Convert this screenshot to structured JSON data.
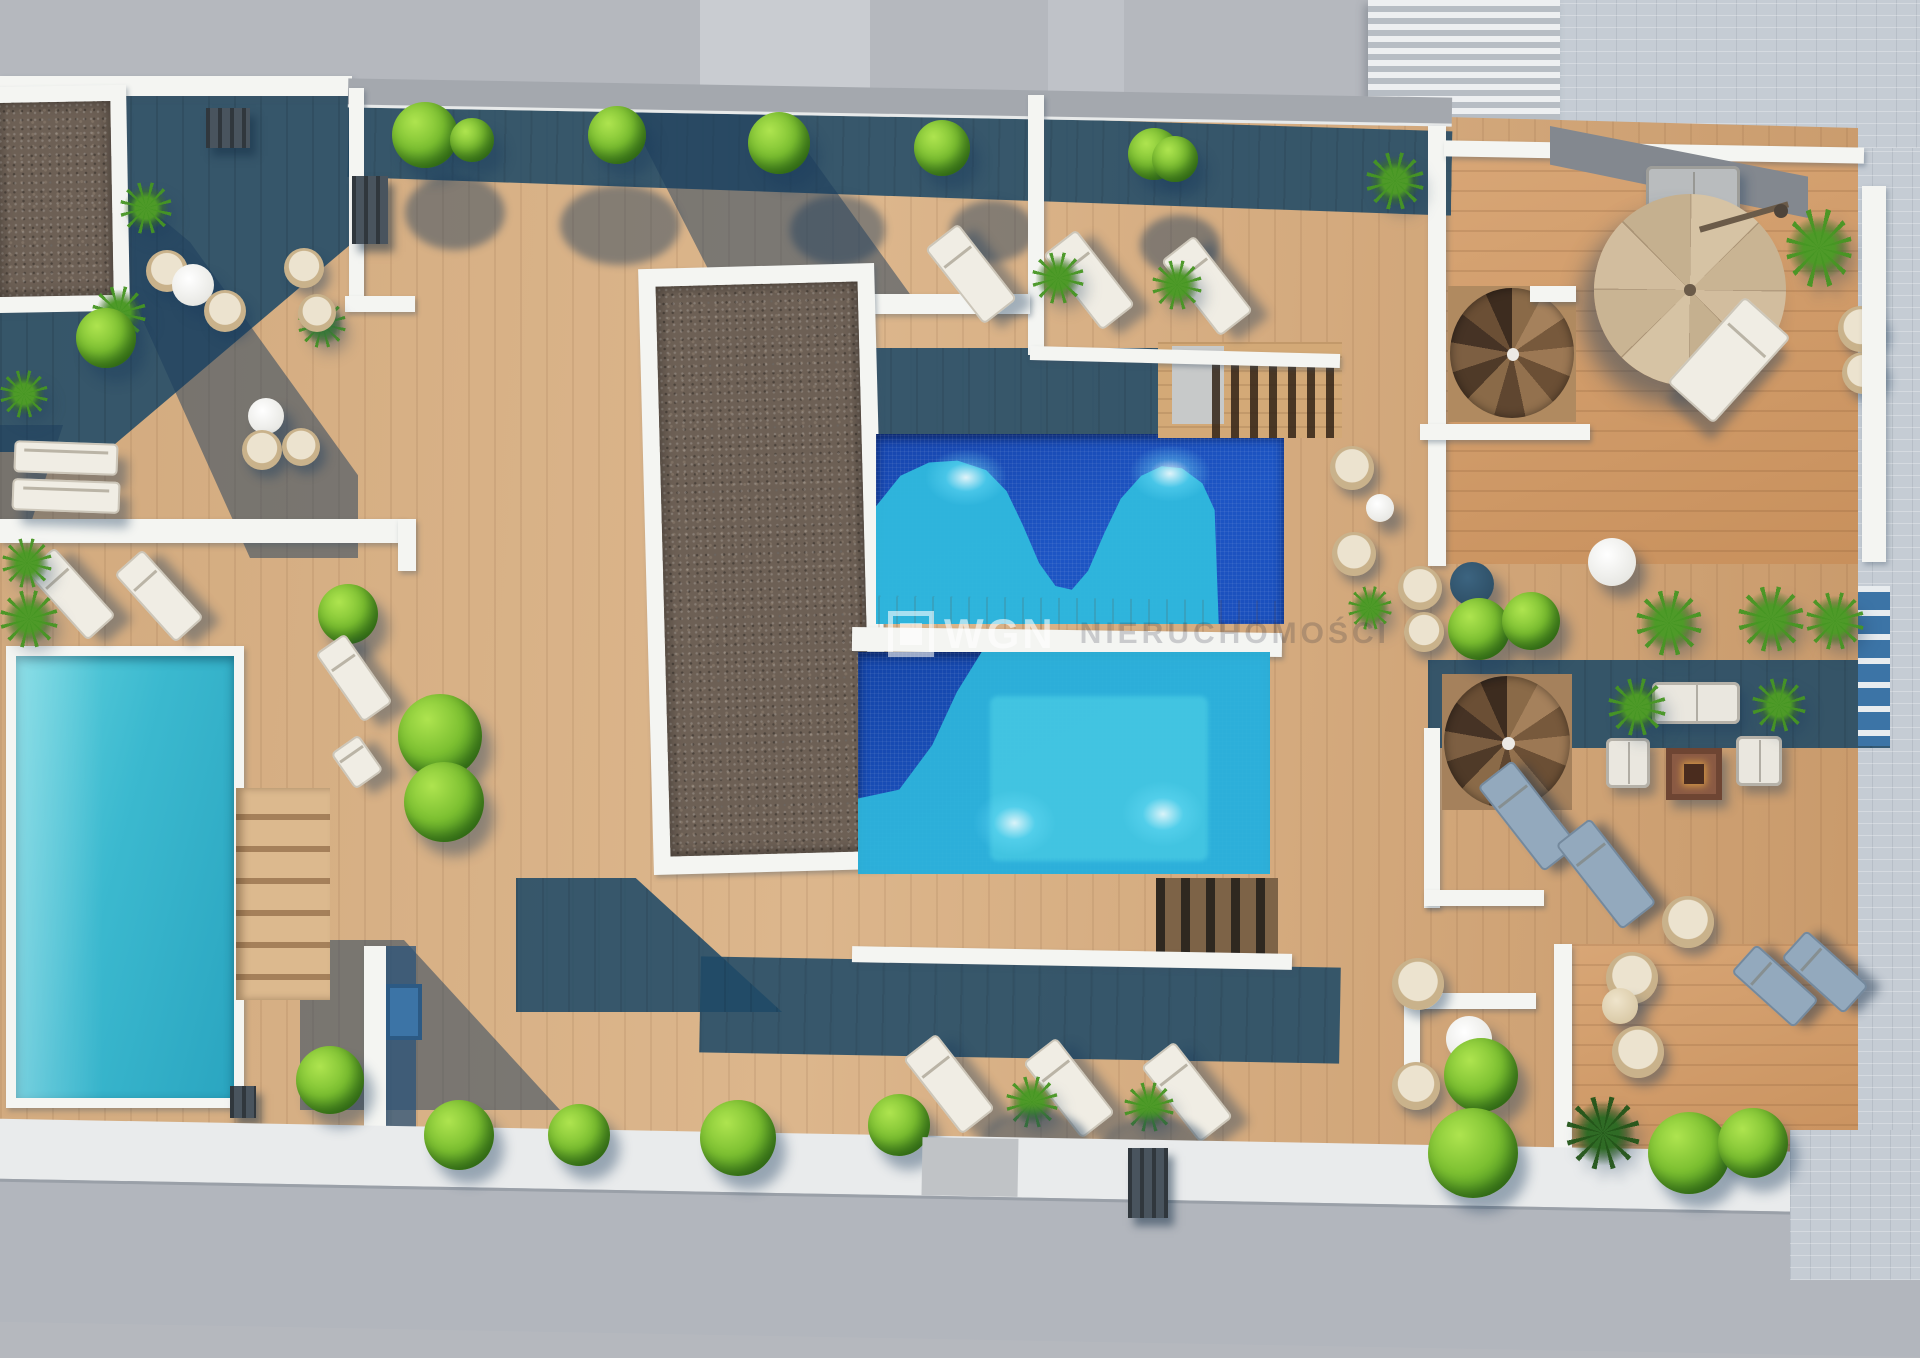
{
  "scene": {
    "kind": "aerial 3d architectural rendering",
    "subject": "rooftop terrace of an apartment building with pools, wooden decks, plants and lounge furniture",
    "watermark": {
      "logo_icon": "wgn-square-logo-icon",
      "text": "WGN",
      "suffix": "NIERUCHOMOŚCI"
    }
  },
  "palette": {
    "street_gray": "#b5b8be",
    "street_light_strip": "#c9ccd1",
    "walkway_white": "#e9ebec",
    "pavement_tile": "#c5ccd4",
    "building_blind_light": "#edeff1",
    "building_blind_dark": "#b7bdc4",
    "wood_sunlit": "#d2aa7e",
    "wood_sunlit_deep": "#c8905c",
    "wood_shadow_teal": "#27556f",
    "wall_white": "#f4f5f2",
    "parapet_gray": "#a4a8ae",
    "gravel_brown": "#6d6055",
    "pool_deep_blue": "#1748b0",
    "pool_turquoise": "#2fb9dd",
    "pool_light": "#49cbe4",
    "left_pool_turquoise": "#3ab9cf",
    "bush_green": "#7cc031",
    "palm_green": "#4e9a28",
    "lounger_white": "#f0ede4",
    "wicker_tan": "#c9b28b",
    "umbrella_tan": "#cdb897",
    "fire_table_rust": "#8a5a44",
    "shadow_teal": "rgba(28,60,92,0.45)"
  },
  "inventory": {
    "pools": 3,
    "gravel_roof_sections": 2,
    "spiral_staircases": 2,
    "cantilever_umbrellas": 1,
    "sun_loungers": 15,
    "hanging_wicker_chairs": 14,
    "round_tables": 7,
    "fire_pit_lounge_sets": 1,
    "wood_staircases": 2,
    "bushes_and_palms": "about 40"
  }
}
